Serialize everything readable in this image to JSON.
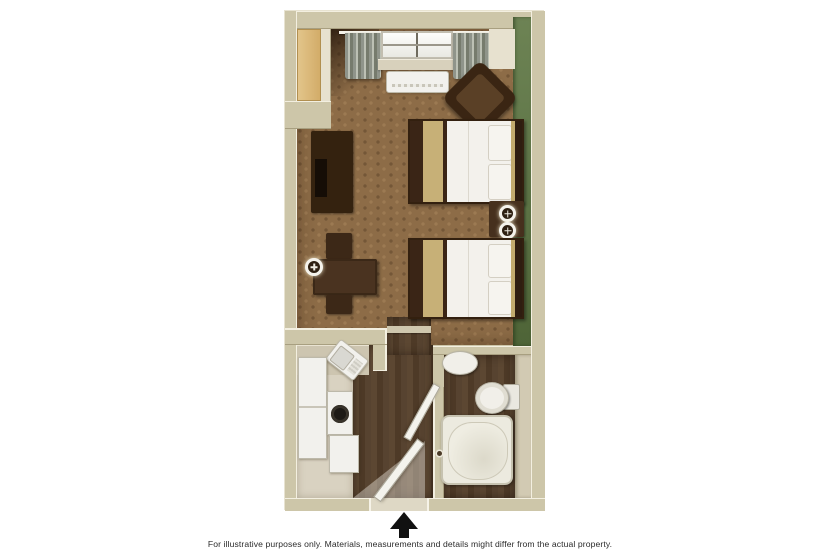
{
  "caption": {
    "text": "For illustrative purposes only.  Materials, measurements and details might differ from the actual property."
  },
  "entrance": {
    "icon": "up-arrow-entrance-marker"
  },
  "palette": {
    "wall_tan": "#cdc6a9",
    "accent_wall_green": "#5d7446",
    "carpet_brown": "#8d6c47",
    "dark_wood_floor": "#523e2a",
    "kitchen_floor": "#d9d2c1",
    "furniture_dark_brown": "#3a2516",
    "bed_runner_khaki": "#c7b077",
    "closet_door_tan": "#dcba7d",
    "fixture_white": "#f2f1ed",
    "arrow_black": "#111111"
  },
  "diagram_data": {
    "type": "floorplan",
    "view": "top-down 3D render of a hotel studio suite",
    "rooms": [
      {
        "name": "main-room",
        "features": [
          "window with striped curtains",
          "wall AC unit below window",
          "brown armchair",
          "green accent wall",
          "two double beds with khaki runners",
          "nightstand with two lamps",
          "TV cabinet",
          "dining table with two chairs",
          "wall lamp",
          "closet at top-left"
        ]
      },
      {
        "name": "kitchenette",
        "features": [
          "corner sink unit (angled)",
          "refrigerator",
          "stove with single burner",
          "lower cabinet",
          "counter along wall"
        ]
      },
      {
        "name": "bathroom",
        "features": [
          "vanity sink",
          "toilet with tank",
          "bathtub",
          "open door",
          "dark wood floor"
        ]
      },
      {
        "name": "entry-hall",
        "features": [
          "open entry door",
          "light spill",
          "dark wood floor",
          "threshold",
          "entrance arrow below plan"
        ]
      }
    ]
  }
}
